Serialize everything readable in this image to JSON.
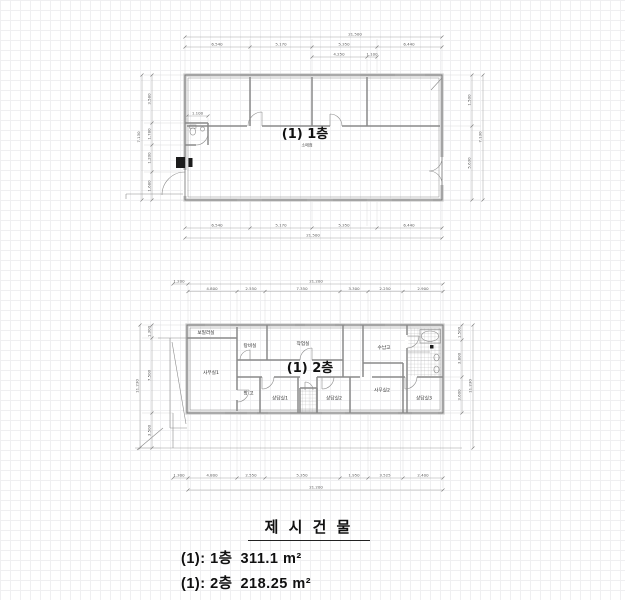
{
  "drawing": {
    "floor1": {
      "title": "(1) 1층",
      "subtitle": "소매점",
      "dims": {
        "total_top": "21.500",
        "top_segments": [
          "6.540",
          "5.170",
          "5.350",
          "6.440"
        ],
        "top_sub": [
          "4.250",
          "1.100"
        ],
        "bottom_segments": [
          "6.540",
          "5.170",
          "5.350",
          "6.440"
        ],
        "total_bottom": "21.500",
        "left_total": "7.130",
        "left_segments": [
          "3.580",
          "1.780",
          "1.200",
          "1.680"
        ],
        "toilet_width": "1.100",
        "right_segments": [
          "1.500",
          "5.630"
        ],
        "right_total": "7.130"
      }
    },
    "floor2": {
      "title": "(1) 2층",
      "rooms": [
        "보일러실",
        "탕비실",
        "작업실",
        "수납고",
        "사무실1",
        "창 고",
        "상담실1",
        "상담실2",
        "사무실2",
        "상담실3"
      ],
      "dims": {
        "offset_left": "1.200",
        "total_top": "21.200",
        "top_segments": [
          "4.800",
          "2.550",
          "7.350",
          "3.300",
          "2.250",
          "2.900"
        ],
        "bottom_segments": [
          "4.800",
          "2.550",
          "5.350",
          "1.950",
          "3.525",
          "2.400"
        ],
        "bottom_offset": "1.300",
        "total_bottom": "21.200",
        "left_total": "11.230",
        "left_segments": [
          "1.300",
          "7.500",
          "3.500"
        ],
        "right_segments": [
          "1.500",
          "3.800",
          "3.600"
        ],
        "right_total": "11.230"
      }
    },
    "legend": {
      "title": "제 시 건 물",
      "items": [
        {
          "label": "(1): 1층",
          "area": "311.1 m²"
        },
        {
          "label": "(1): 2층",
          "area": "218.25 m²"
        }
      ]
    }
  }
}
